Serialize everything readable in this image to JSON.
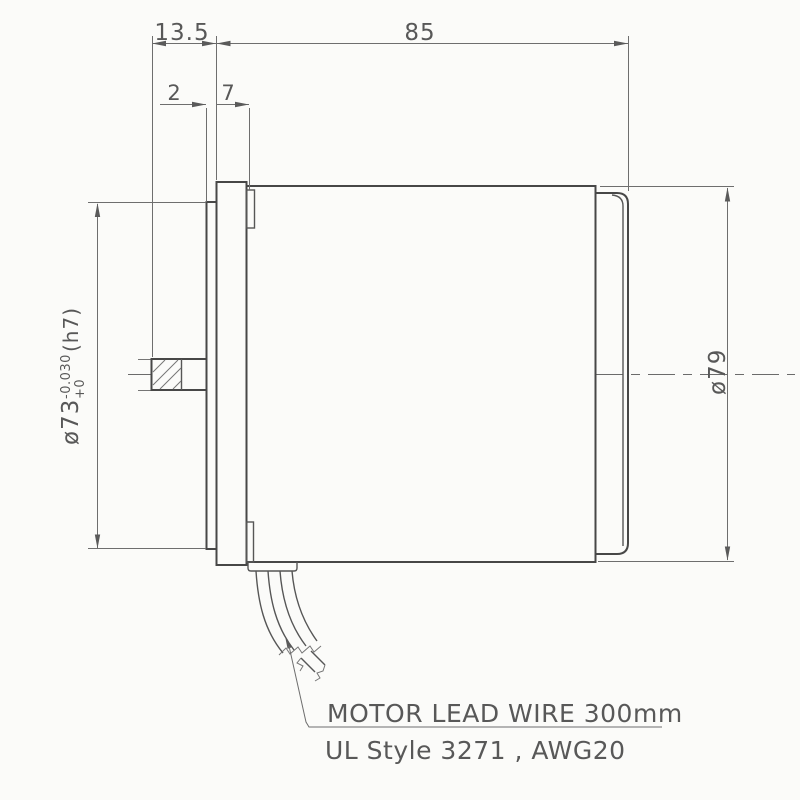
{
  "drawing_type": "motor-dimensional-drawing",
  "dimensions": {
    "overall_length": "85",
    "shaft_protrusion": "13.5",
    "pilot_protrusion": "2",
    "flange_thickness": "7",
    "pilot_diameter": {
      "main": "ø73",
      "tolerance_upper": "+0",
      "tolerance_lower": "-0.030",
      "fit": "(h7)"
    },
    "body_diameter": "ø79"
  },
  "notes": {
    "lead_wire": "MOTOR LEAD WIRE 300mm",
    "wire_spec": "UL Style 3271 , AWG20"
  },
  "colors": {
    "paper": "#fbfbf9",
    "line_dark": "#474747",
    "line_dim": "#6e6e6e",
    "text": "#585858"
  }
}
